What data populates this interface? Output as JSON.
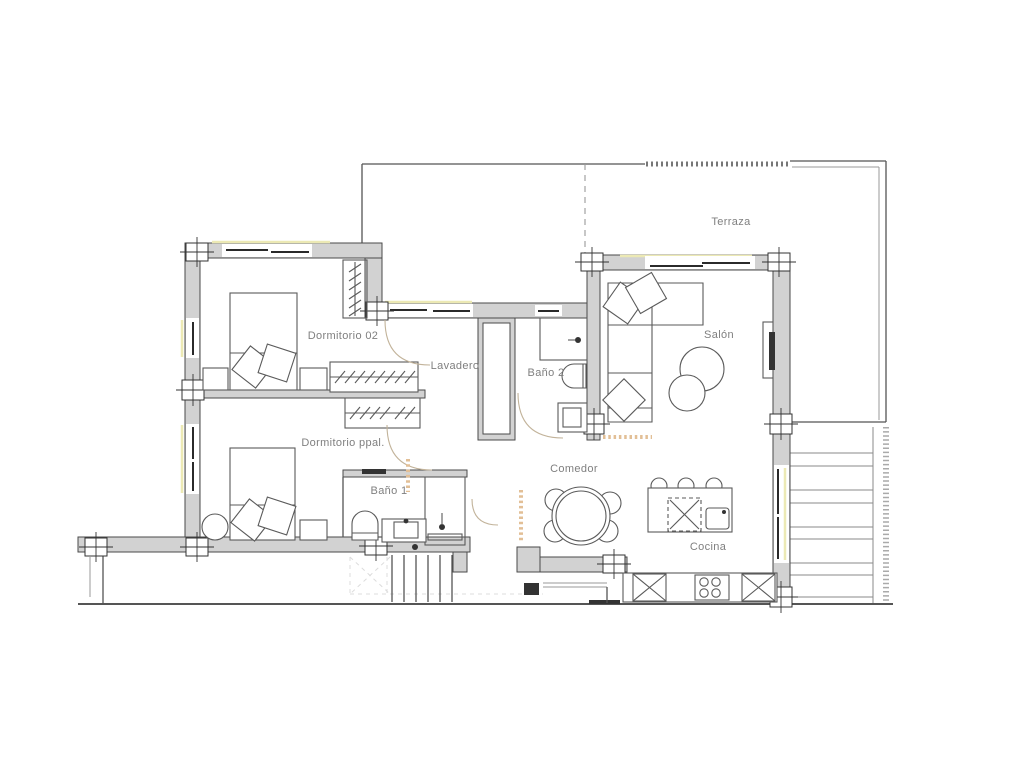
{
  "plan": {
    "title": "Apartment floor plan",
    "rooms": [
      {
        "id": "terraza",
        "label": "Terraza"
      },
      {
        "id": "dormitorio-02",
        "label": "Dormitorio 02"
      },
      {
        "id": "lavadero",
        "label": "Lavadero"
      },
      {
        "id": "bano-2",
        "label": "Baño 2"
      },
      {
        "id": "salon",
        "label": "Salón"
      },
      {
        "id": "dormitorio-ppal",
        "label": "Dormitorio ppal."
      },
      {
        "id": "bano-1",
        "label": "Baño 1"
      },
      {
        "id": "comedor",
        "label": "Comedor"
      },
      {
        "id": "cocina",
        "label": "Cocina"
      }
    ],
    "colors": {
      "wall_fill": "#d2d2d2",
      "wall_stroke": "#4a4a4a",
      "line": "#555555",
      "light_line": "#999999",
      "label_text": "#7f7f7f",
      "accent_yellow": "#ece9b4",
      "accent_orange": "#e2bf96",
      "arc_color": "#c2b39a",
      "bg": "#ffffff"
    }
  }
}
